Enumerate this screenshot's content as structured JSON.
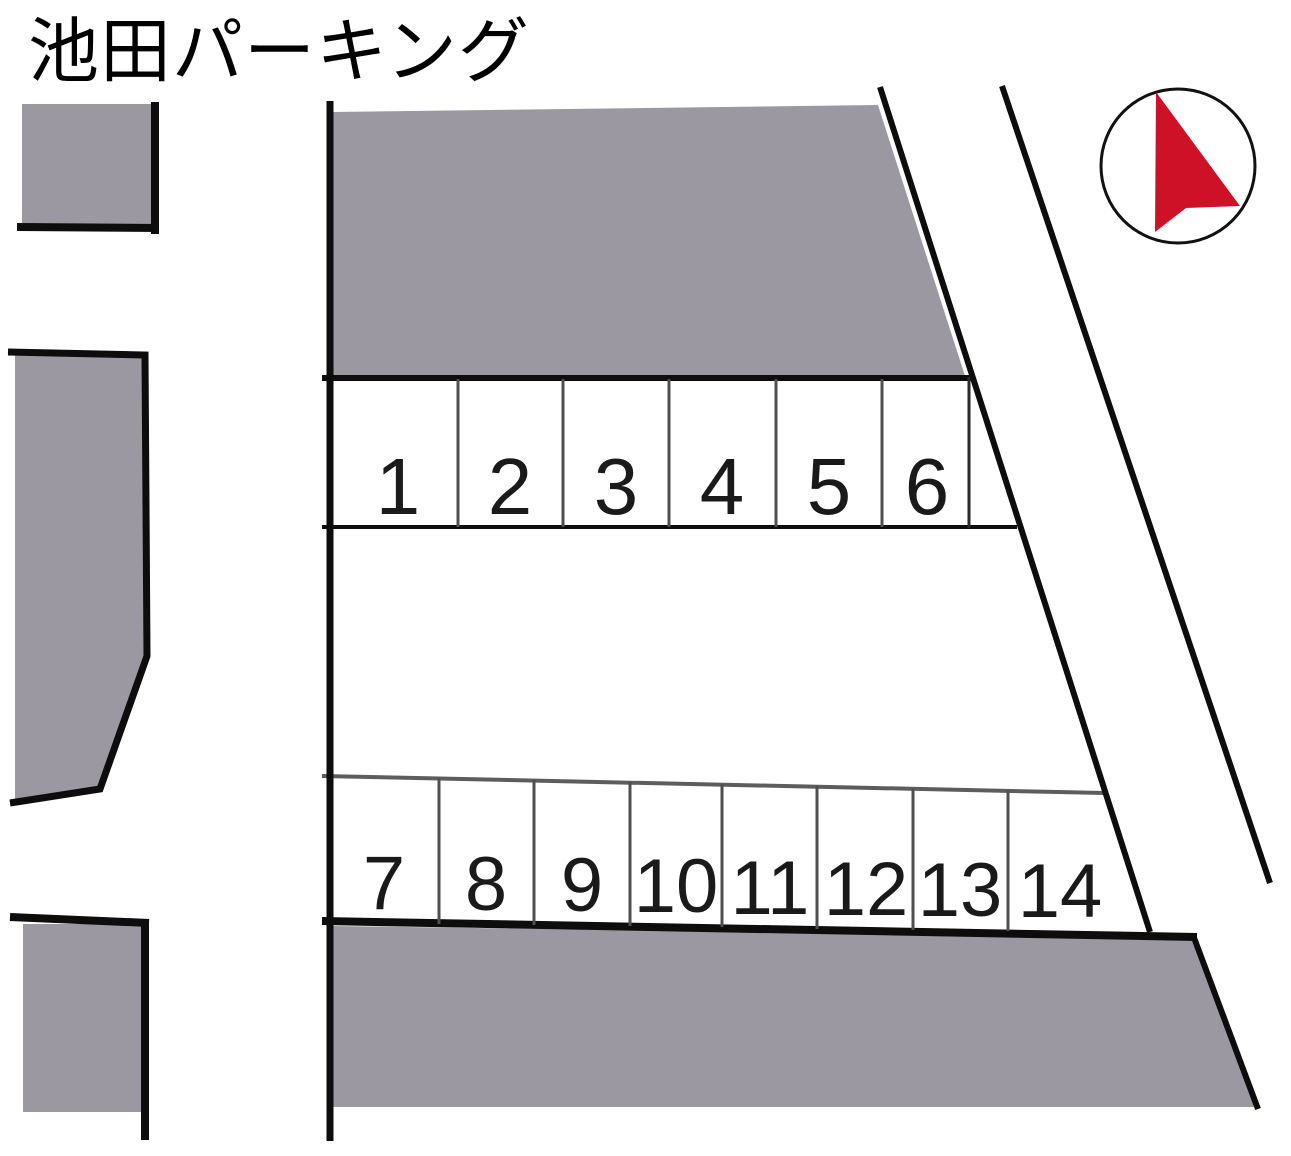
{
  "title": "池田パーキング",
  "map": {
    "spaces_row1": [
      "1",
      "2",
      "3",
      "4",
      "5",
      "6"
    ],
    "spaces_row2": [
      "7",
      "8",
      "9",
      "10",
      "11",
      "12",
      "13",
      "14"
    ],
    "rows": [
      {
        "name": "upper-row",
        "count": 6
      },
      {
        "name": "lower-row",
        "count": 8
      }
    ],
    "compass": "north-arrow",
    "colors": {
      "building_gray": "#9b98a2",
      "outline_black": "#0d0d0d",
      "divider_gray": "#4f4f4f",
      "compass_red": "#ce1126",
      "background_white": "#ffffff"
    }
  }
}
